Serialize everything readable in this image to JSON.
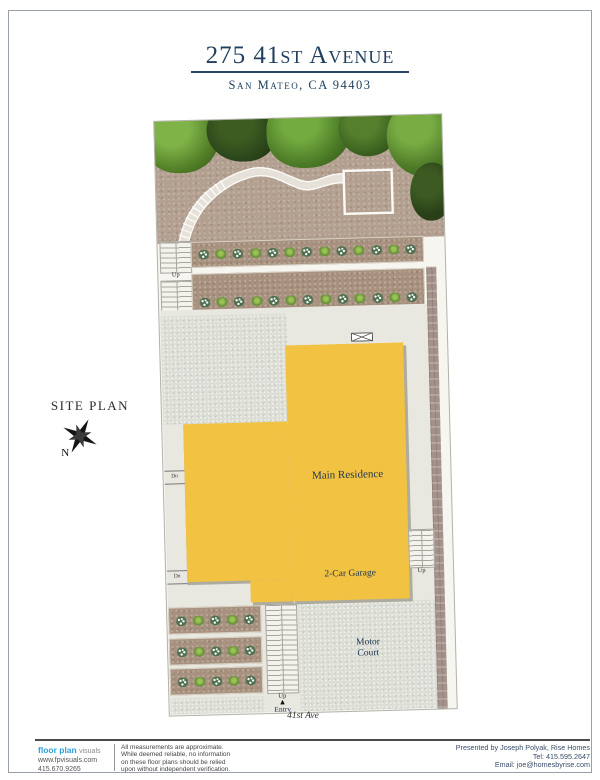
{
  "header": {
    "title": "275 41st Avenue",
    "subtitle": "San Mateo, CA 94403"
  },
  "plan": {
    "section_label": "SITE PLAN",
    "compass_north": "N",
    "building": {
      "main_label": "Main Residence",
      "garage_label": "2-Car Garage"
    },
    "areas": {
      "motor_court": [
        "Motor",
        "Court"
      ]
    },
    "street": "41st Ave",
    "entry_label": "Entry",
    "entry_arrow": "▲",
    "stair_up": "Up",
    "stair_down": "Dn",
    "colors": {
      "residence_yellow": "#f2c243",
      "dirt_brown": "#b3a090",
      "label_navy": "#1e3450"
    }
  },
  "footer": {
    "brand": {
      "name_bold": "floor plan",
      "name_light": "visuals",
      "website": "www.fpvisuals.com",
      "phone": "415.670.9265"
    },
    "disclaimer": [
      "All measurements are approximate.",
      "While deemed reliable, no information",
      "on these floor plans should be relied",
      "upon without independent verification."
    ],
    "presented": [
      "Presented by Joseph Polyak, Rise Homes",
      "Tel: 415.595.2647",
      "Email: joe@homesbyrise.com"
    ]
  }
}
